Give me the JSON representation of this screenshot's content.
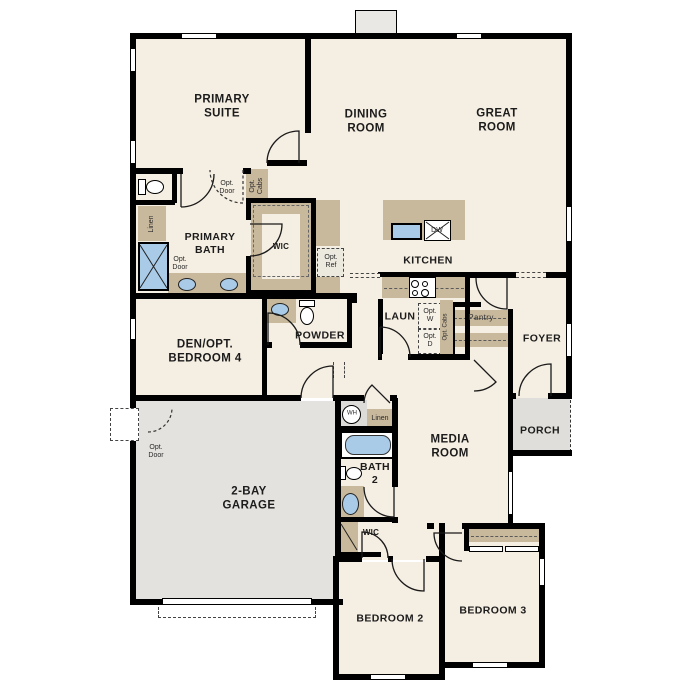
{
  "plan_type": "single-story floor plan",
  "colors": {
    "background": "#ffffff",
    "floor": "#f5eee2",
    "wall": "#000000",
    "cabinet": "#c8b89c",
    "garage_floor": "#e3e2de",
    "porch_floor": "#dfdeda",
    "chimney": "#e9e8e4",
    "fixture_blue": "#a9cbe8",
    "optional_fill": "#f7f2e8"
  },
  "rooms": {
    "primary_suite": "PRIMARY\nSUITE",
    "dining_room": "DINING\nROOM",
    "great_room": "GREAT\nROOM",
    "primary_bath": "PRIMARY\nBATH",
    "wic_primary": "WIC",
    "kitchen": "KITCHEN",
    "laundry": "LAUN",
    "pantry": "Pantry",
    "powder": "POWDER",
    "den_opt_bedroom4": "DEN/OPT.\nBEDROOM 4",
    "foyer": "FOYER",
    "garage": "2-BAY\nGARAGE",
    "media_room": "MEDIA\nROOM",
    "bath2": "BATH\n2",
    "wic_bedroom2": "WIC",
    "bedroom2": "BEDROOM 2",
    "bedroom3": "BEDROOM 3",
    "porch": "PORCH"
  },
  "fixtures": {
    "dishwasher": "DW",
    "water_heater": "WH",
    "linen_bath": "Linen",
    "linen_hall": "Linen"
  },
  "optional_features": {
    "opt_door_suite": "Opt.\nDoor",
    "opt_door_bath": "Opt.\nDoor",
    "opt_door_garage": "Opt.\nDoor",
    "opt_cabs_dining": "Opt.\nCabs",
    "opt_cabs_laundry": "Opt. Cabs",
    "opt_ref": "Opt.\nRef",
    "opt_washer": "Opt.\nW",
    "opt_dryer": "Opt.\nD"
  }
}
